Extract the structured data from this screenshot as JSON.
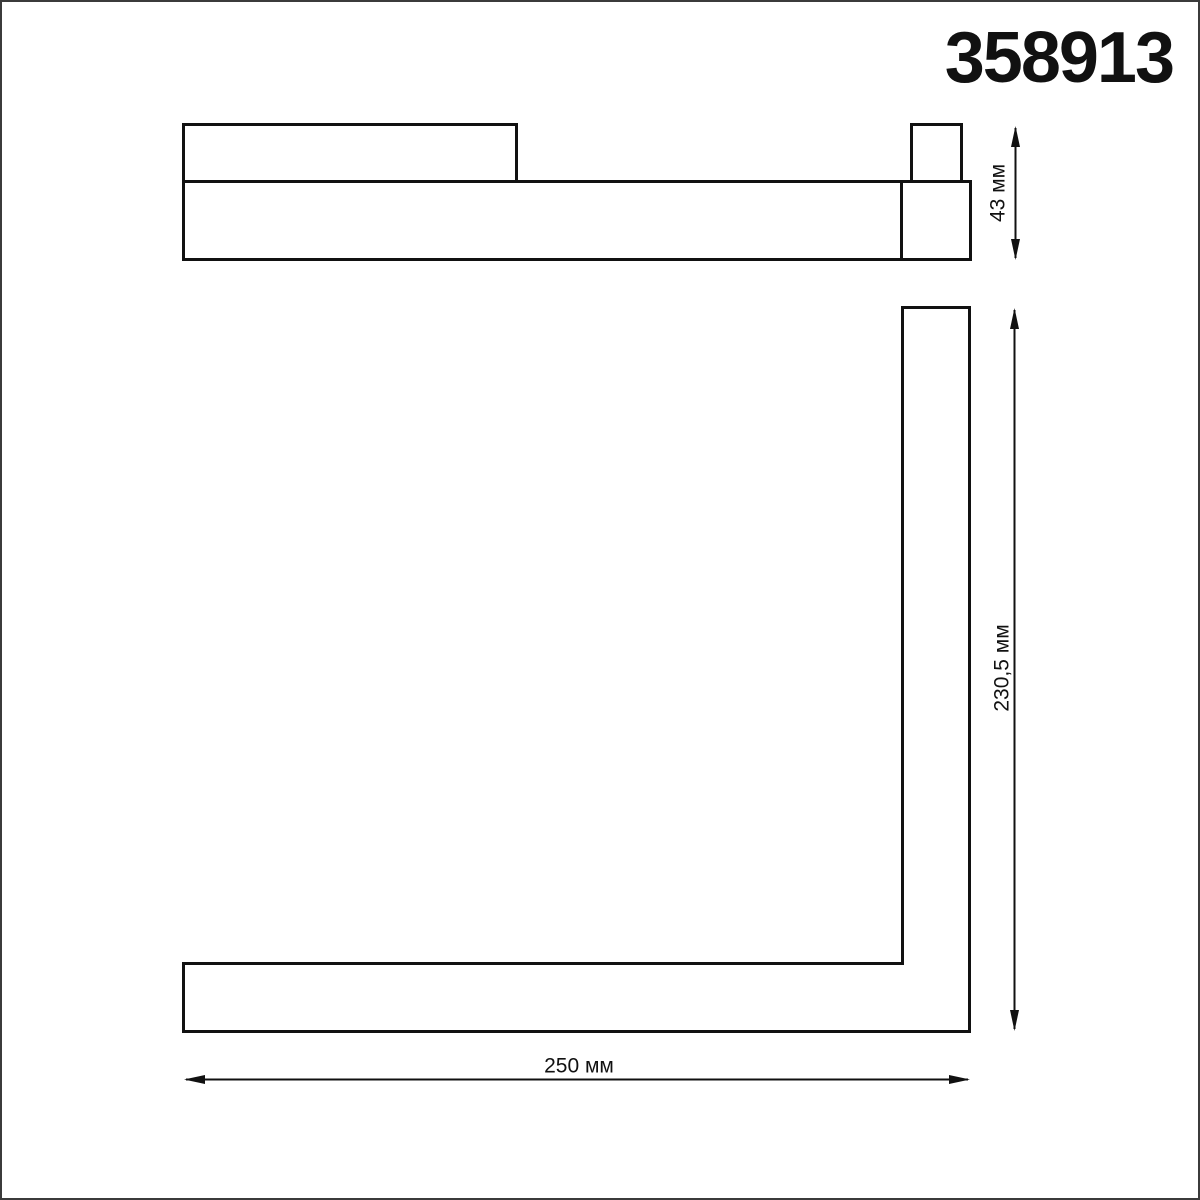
{
  "product_code": "358913",
  "colors": {
    "line": "#111111",
    "frame": "#3b3b3b",
    "background": "#ffffff"
  },
  "drawing": {
    "side_profile_view": {
      "name": "side profile view of track light module",
      "height_dim_label": "43 мм"
    },
    "front_view": {
      "name": "L-shaped front view of track light module",
      "height_dim_label": "230,5 мм",
      "width_dim_label": "250 мм"
    }
  }
}
